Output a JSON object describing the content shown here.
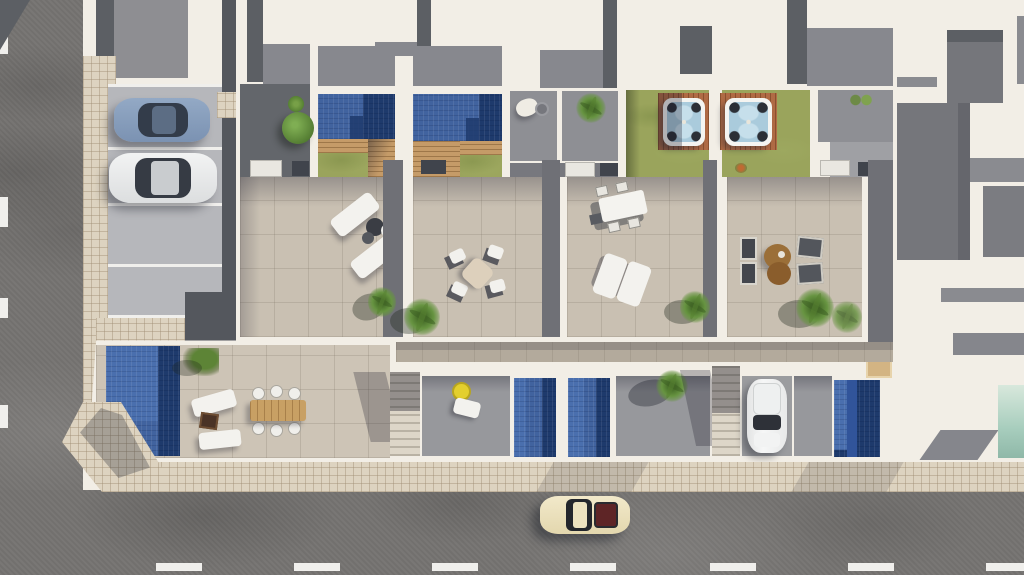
{
  "scene": {
    "title": "aerial-render-townhouse-development",
    "description": "Top-down 3D architectural rendering: four attached townhouses with rooftop pools, hot tubs, furnished terraces, ground-floor gardens with pools, street parking and surrounding roads. No text is visible in the image.",
    "units": 4,
    "inventory": {
      "rooftop_pools": 2,
      "hot_tubs": 2,
      "ground_pools": 4,
      "neighbor_pool": 1,
      "cars": [
        {
          "name": "blue-car-parked",
          "color": "#8298b6"
        },
        {
          "name": "white-car-parked",
          "color": "#eceded"
        },
        {
          "name": "white-car-driveway",
          "color": "#f0f1f1"
        },
        {
          "name": "cream-car-street",
          "color": "#ece2c0"
        }
      ],
      "furniture": [
        "sun-loungers",
        "parasol",
        "dining-table-4-chairs",
        "dining-table-6-chairs",
        "outdoor-sofa-set",
        "round-poufs",
        "fire-pit",
        "yellow-float",
        "beanbag"
      ]
    },
    "palette": {
      "road": "#767472",
      "sidewalk": "#ddd3c0",
      "parking": "#b6b7bb",
      "driveway": "#54575d",
      "roof_dark": "#5c5f64",
      "roof_mid": "#8e8e92",
      "deck_gray": "#87888e",
      "wall": "#f2eee6",
      "patio_dark": "#63666b",
      "patio_gray": "#8e8f94",
      "strip_gray": "#6f7076",
      "lawn": "#9aa45c",
      "pool": "#41639f",
      "pool_dark": "#1e3a6c",
      "pool_light": "#4a6fae",
      "wood": "#c59b68",
      "tub_deck": "#b06b45",
      "terrace": "#c9c0b2",
      "walkway": "#b3aa9c",
      "yard": "#97989c",
      "garden": "#cdc4b6",
      "stairs": "#d9d2c4",
      "ac_dark": "#40444c",
      "white_item": "#f1f1ee",
      "table_wood": "#c8a064",
      "brown": "#9b6f38",
      "yellow": "#e3cf2e",
      "teal": "#aed2c2",
      "neighbor_gray": "#75767b",
      "neighbor_band": "#8a8b90",
      "lane_mark": "#f0efec"
    }
  }
}
